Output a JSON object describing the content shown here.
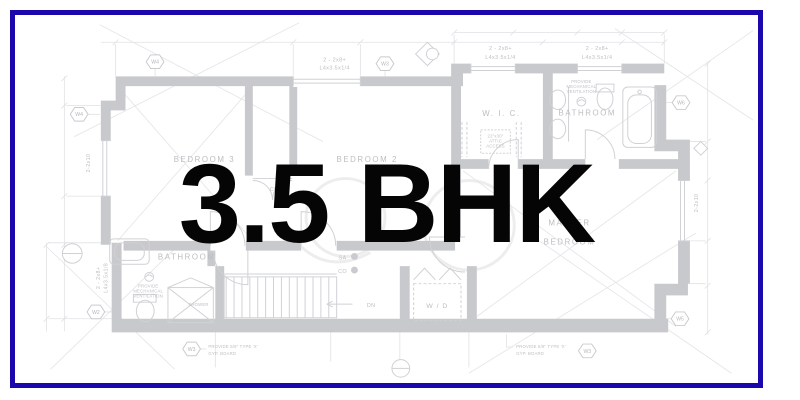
{
  "frame": {
    "border_color": "#1b08ad",
    "background": "#ffffff"
  },
  "overlay": {
    "title": "3.5 BHK",
    "color": "#050505"
  },
  "plan": {
    "wall_color": "#c7c9cc",
    "line_color": "#e0e2e4",
    "label_color": "#bcbec1",
    "rooms": {
      "bedroom3": "BEDROOM 3",
      "bedroom2": "BEDROOM 2",
      "wic": "W. I. C.",
      "bathroom_top": "BATHROOM",
      "master_line1": "MASTER",
      "master_line2": "BEDROOM",
      "bathroom_left": "BATHROOM",
      "laundry": "W / D",
      "closet": "CL."
    },
    "labels": {
      "dn": "DN",
      "sa": "SA",
      "co": "CO",
      "shower": "SHOWER"
    },
    "notes": {
      "beam_size": "2 - 2x8+",
      "beam_angle_14": "L4x3.5x1/4",
      "beam_angle_18": "L4x3.5x1/8",
      "joist": "2-2x10",
      "vent_line1": "PROVIDE",
      "vent_line2": "MECHANICAL",
      "vent_line3": "VENTILATION",
      "gyp_line1": "PROVIDE 5/8\" TYPE 'X'",
      "gyp_line2": "GYP. BOARD",
      "attic_line1": "22\"x30\"",
      "attic_line2": "ATTIC",
      "attic_line3": "ACCESS"
    },
    "window_markers": {
      "w2": "W2",
      "w3": "W3",
      "w4": "W4",
      "w5": "W5",
      "w6": "W6"
    }
  }
}
